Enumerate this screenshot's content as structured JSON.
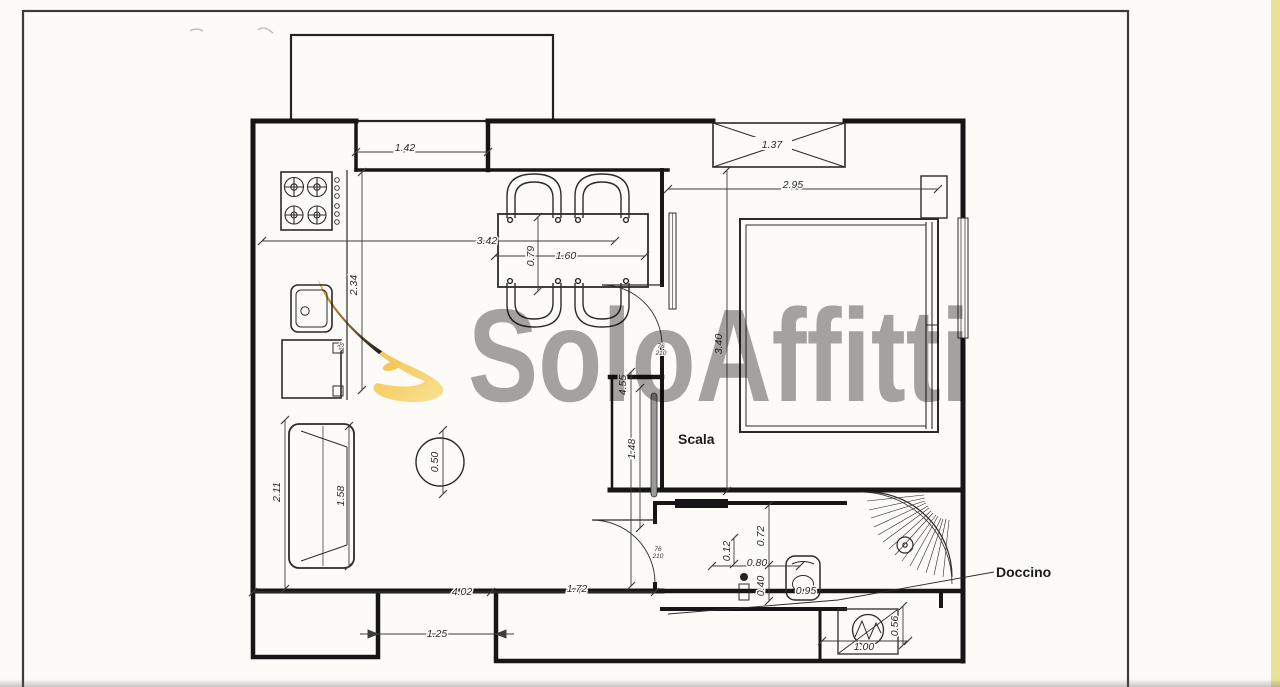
{
  "page": {
    "paper_color": "#fcfbf7",
    "frame_color": "#3b3b40",
    "edge_strip_color": "#e9e194"
  },
  "watermark": {
    "brand": "SoloAffitti",
    "logo": "swoosh-icon",
    "logo_color": "#f2b93a",
    "text_color": "#6e6e6e"
  },
  "labels": {
    "stairs": "Scala",
    "shower": "Doccino"
  },
  "dims": {
    "recess": "1.42",
    "shaft": "1.37",
    "bedroom_w": "2.95",
    "kitchen_w": "3.42",
    "table_l": "1.60",
    "table_d": "0.79",
    "kitchen_d": "2.34",
    "bedroom_h": "3.40",
    "hall_h": "4.55",
    "stair_w": "1.48",
    "sofa_wall": "2.11",
    "sofa_l": "1.58",
    "table_round": "0.50",
    "bath_a": "0.12",
    "bath_b": "0.72",
    "bath_w": "0.80",
    "wc_off": "0.40",
    "wc_w": "0.95",
    "living_w": "4.02",
    "living_part": "1.72",
    "gap": "1.25",
    "boiler_w": "1.00",
    "boiler_d": "0.56",
    "cab_note": "25"
  },
  "door_tags": {
    "bed_w": "76",
    "bed_h": "210",
    "bath_w": "76",
    "bath_h": "210"
  }
}
